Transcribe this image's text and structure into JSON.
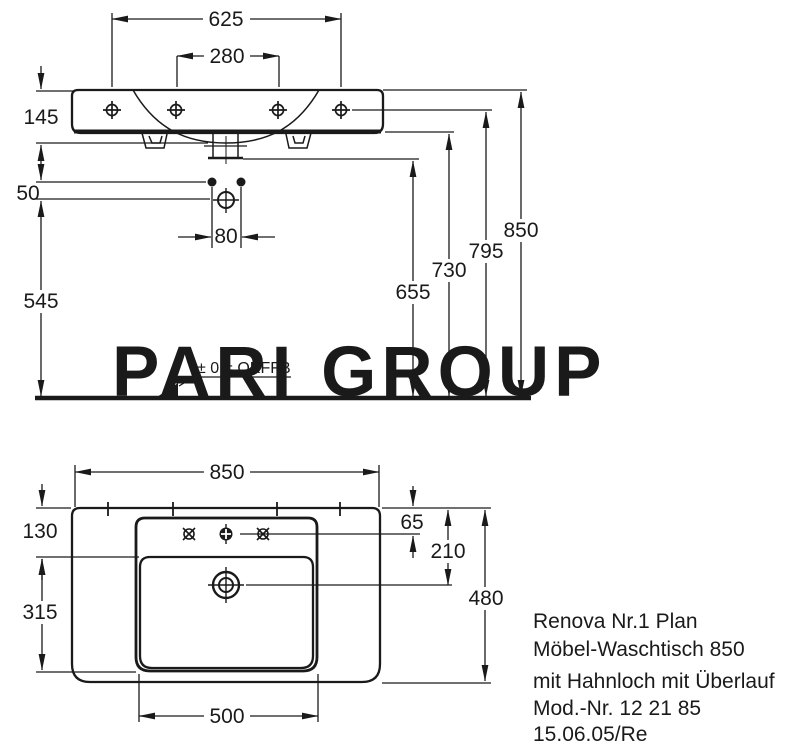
{
  "watermark": {
    "text": "PARI GROUP"
  },
  "front_view": {
    "title": "front-elevation",
    "dimensions": {
      "hole_spacing_outer": "625",
      "hole_spacing_inner": "280",
      "basin_height": "145",
      "fixing_offset": "50",
      "screw_spacing": "80",
      "siphon_height": "545",
      "outlet_height": "655",
      "basin_bottom_height": "730",
      "hole_height": "795",
      "rim_height": "850"
    },
    "floor_reference_label": "± 0 = OKFFB"
  },
  "plan_view": {
    "title": "plan-view",
    "dimensions": {
      "overall_width": "850",
      "ledge_depth": "130",
      "bowl_depth": "315",
      "bowl_width": "500",
      "tap_hole_offset": "65",
      "drain_offset": "210",
      "overall_depth": "480"
    }
  },
  "product_info": {
    "line1": "Renova Nr.1 Plan",
    "line2": "Möbel-Waschtisch 850",
    "line3": "mit Hahnloch mit Überlauf",
    "line4": "Mod.-Nr. 12 21 85",
    "line5": "15.06.05/Re"
  },
  "colors": {
    "line": "#1a1a1a",
    "watermark": "#c7c7c7",
    "background": "#ffffff"
  }
}
